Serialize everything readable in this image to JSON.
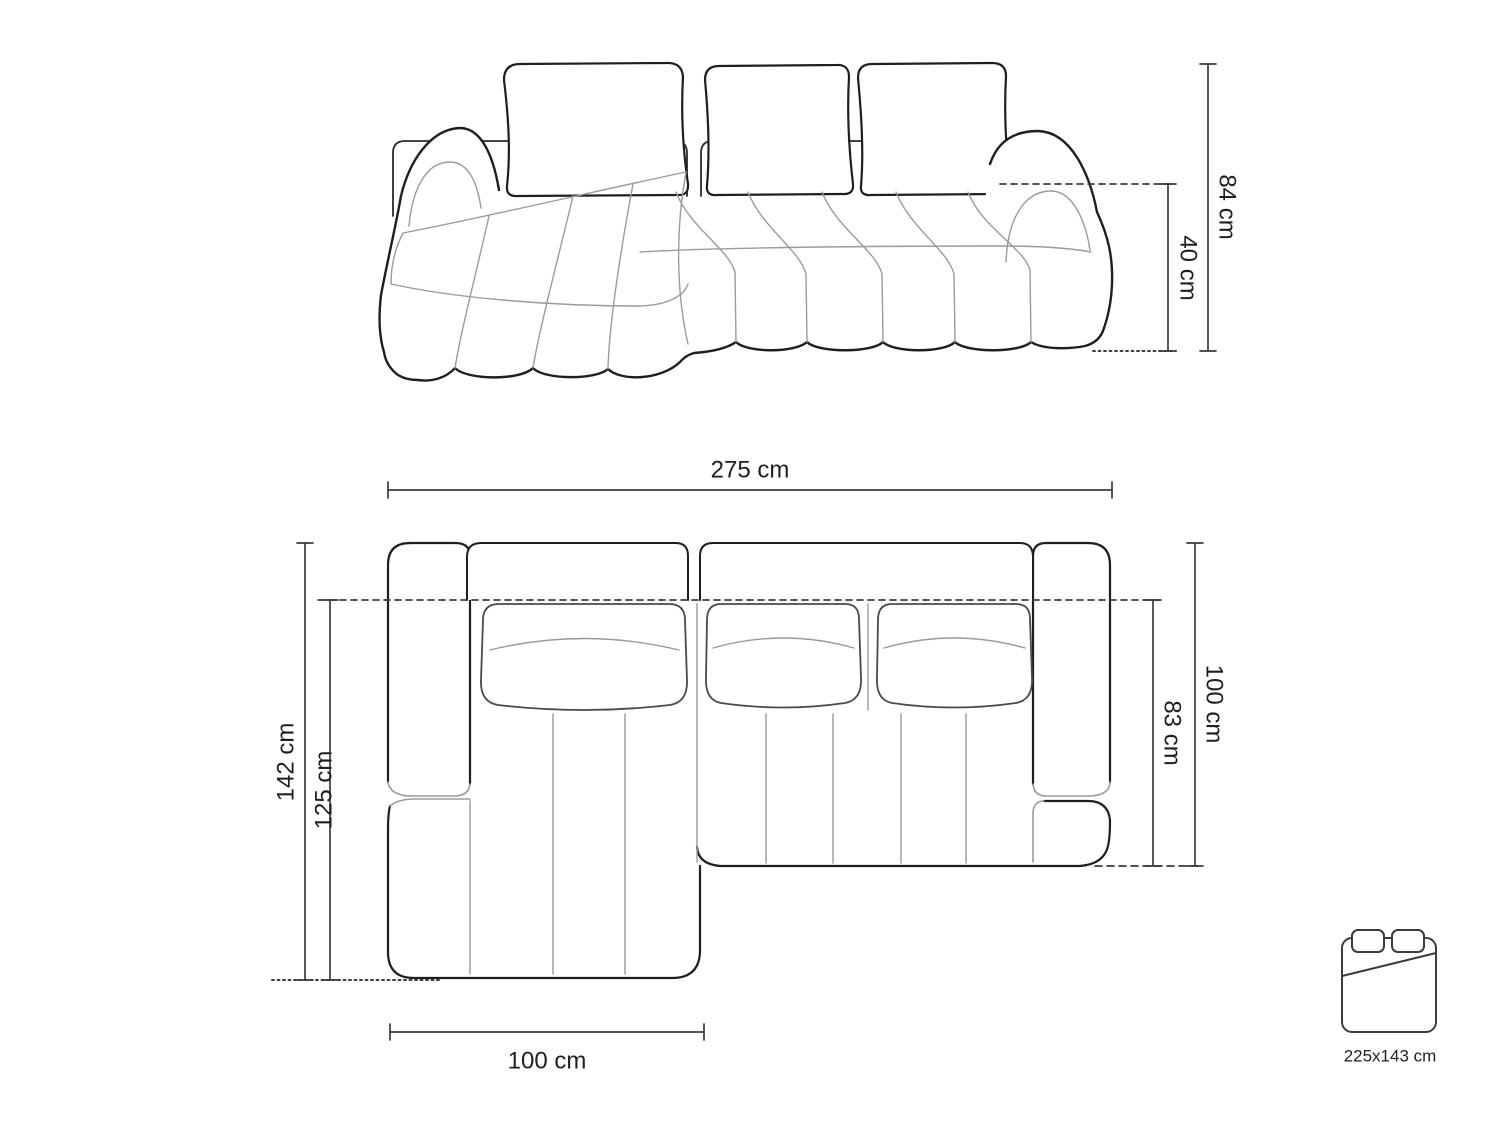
{
  "diagram": {
    "type": "sofa-dimension-drawing",
    "front_view": {
      "dimensions": {
        "total_height": "84 cm",
        "seat_height": "40 cm"
      }
    },
    "top_view": {
      "dimensions": {
        "total_width": "275 cm",
        "total_depth": "142 cm",
        "chaise_depth": "125 cm",
        "chaise_width": "100 cm",
        "side_depth": "100 cm",
        "seat_depth": "83 cm"
      }
    },
    "sleeping_area": {
      "icon": "bed-icon",
      "size_label": "225x143 cm"
    }
  },
  "colors": {
    "background": "#ffffff",
    "outline": "#1f1f1f",
    "seam": "#9b9b9b",
    "dimension": "#3c3c3c"
  }
}
